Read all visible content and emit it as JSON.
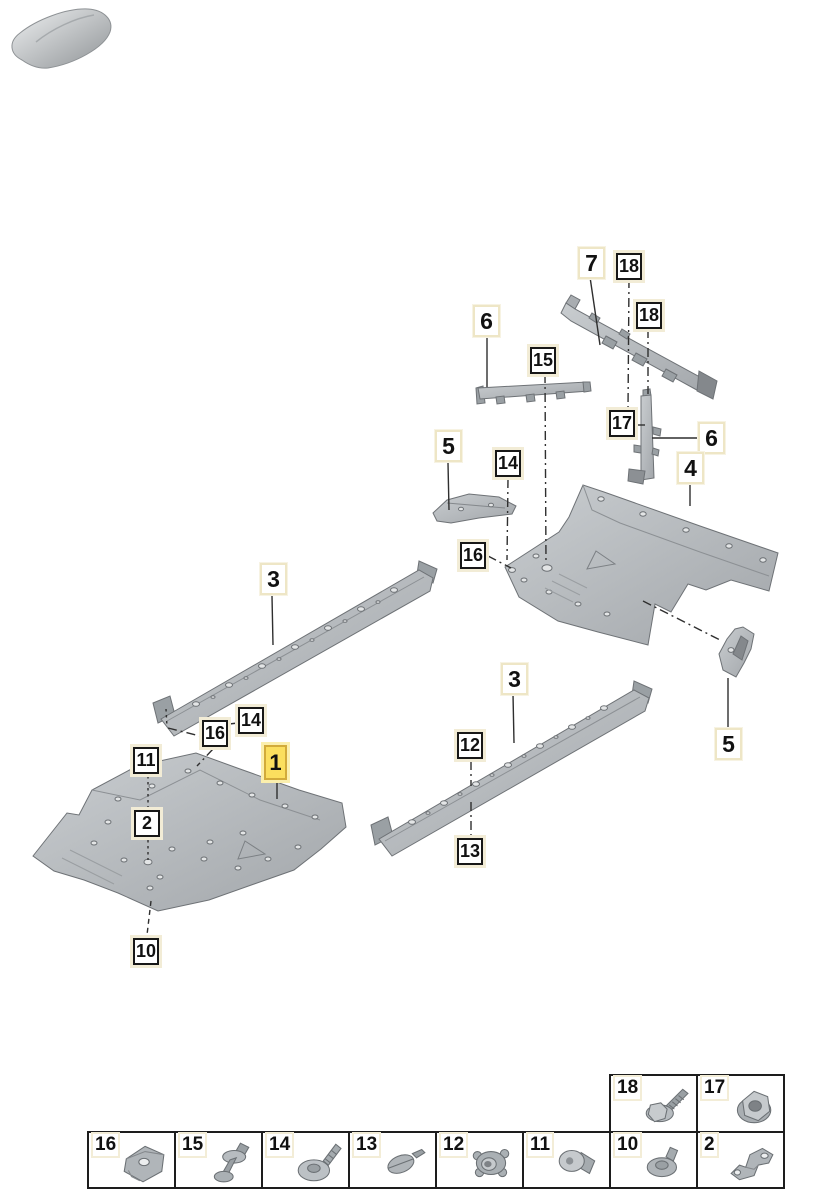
{
  "page": {
    "kind": "underbody-panel-parts-diagram"
  },
  "colors": {
    "background": "#ffffff",
    "highlight_bg": "#fbdf5e",
    "highlight_border": "#d2ab3a",
    "callout_cream_outline": "#f2ecd6",
    "part_callout_border": "#eee6c6",
    "fastener_callout_border": "#171717",
    "part_fill": "#b5b9bc",
    "part_stroke": "#6e7276",
    "line_color": "#2f2f2f"
  },
  "car_thumbnail": {
    "icon": "car-top-view-icon"
  },
  "diagram": {
    "callouts": [
      {
        "label": "7",
        "x": 578,
        "y": 247,
        "kind": "part"
      },
      {
        "label": "18",
        "x": 616,
        "y": 253,
        "kind": "fastener"
      },
      {
        "label": "18",
        "x": 636,
        "y": 302,
        "kind": "fastener"
      },
      {
        "label": "6",
        "x": 473,
        "y": 305,
        "kind": "part"
      },
      {
        "label": "15",
        "x": 530,
        "y": 347,
        "kind": "fastener"
      },
      {
        "label": "17",
        "x": 609,
        "y": 410,
        "kind": "fastener"
      },
      {
        "label": "6",
        "x": 698,
        "y": 422,
        "kind": "part"
      },
      {
        "label": "5",
        "x": 435,
        "y": 430,
        "kind": "part"
      },
      {
        "label": "14",
        "x": 495,
        "y": 450,
        "kind": "fastener"
      },
      {
        "label": "4",
        "x": 677,
        "y": 452,
        "kind": "part"
      },
      {
        "label": "16",
        "x": 460,
        "y": 542,
        "kind": "fastener"
      },
      {
        "label": "3",
        "x": 260,
        "y": 563,
        "kind": "part"
      },
      {
        "label": "3",
        "x": 501,
        "y": 663,
        "kind": "part"
      },
      {
        "label": "14",
        "x": 238,
        "y": 707,
        "kind": "fastener"
      },
      {
        "label": "16",
        "x": 202,
        "y": 720,
        "kind": "fastener"
      },
      {
        "label": "5",
        "x": 715,
        "y": 728,
        "kind": "part"
      },
      {
        "label": "12",
        "x": 457,
        "y": 732,
        "kind": "fastener"
      },
      {
        "label": "11",
        "x": 133,
        "y": 747,
        "kind": "fastener"
      },
      {
        "label": "1",
        "x": 264,
        "y": 745,
        "kind": "highlight"
      },
      {
        "label": "2",
        "x": 134,
        "y": 810,
        "kind": "fastener"
      },
      {
        "label": "13",
        "x": 457,
        "y": 838,
        "kind": "fastener"
      },
      {
        "label": "10",
        "x": 133,
        "y": 938,
        "kind": "fastener"
      }
    ]
  },
  "legend": {
    "top_cells": [
      {
        "num": "18",
        "icon": "flange-bolt-icon"
      },
      {
        "num": "17",
        "icon": "flange-nut-icon"
      }
    ],
    "cells": [
      {
        "num": "16",
        "icon": "clip-nut-icon"
      },
      {
        "num": "15",
        "icon": "expander-rivet-icon"
      },
      {
        "num": "14",
        "icon": "washer-screw-icon"
      },
      {
        "num": "13",
        "icon": "flat-pin-icon"
      },
      {
        "num": "12",
        "icon": "grommet-icon"
      },
      {
        "num": "11",
        "icon": "pan-head-screw-icon"
      },
      {
        "num": "10",
        "icon": "washer-pin-icon"
      },
      {
        "num": "2",
        "icon": "metal-bracket-icon"
      }
    ]
  }
}
